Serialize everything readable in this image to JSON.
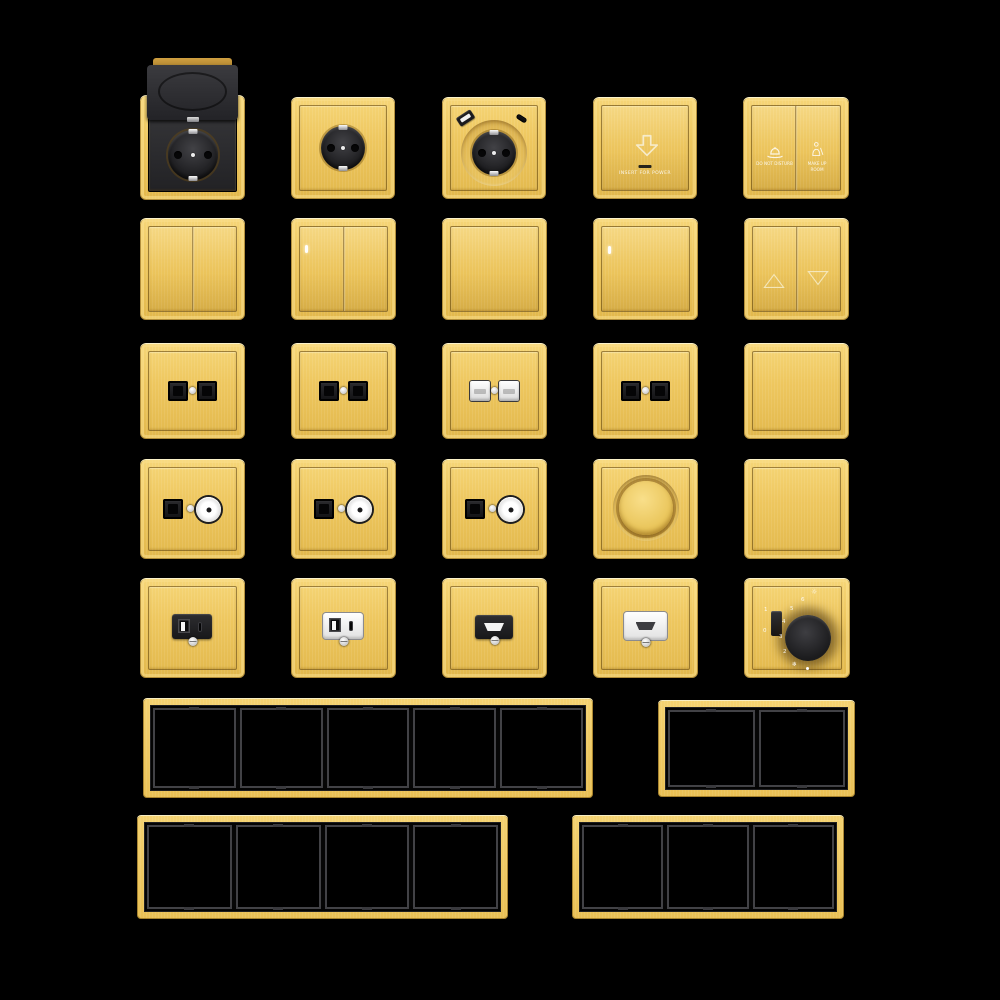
{
  "background": "#000000",
  "palette": {
    "gold": "#eec75f",
    "gold_light": "#f6d678",
    "gold_dark": "#a37a28",
    "part_black": "#232327",
    "part_white": "#f2f2f2",
    "frame_opening_black": "#000000",
    "frame_divider_gray": "#424246",
    "etch_white": "#ffffff"
  },
  "products": {
    "row1": [
      "covered schuko socket",
      "schuko socket",
      "schuko socket with USB-A and USB-C",
      "key card power holder",
      "hotel service two-button switch"
    ],
    "row2": [
      "2-gang rocker switch",
      "2-gang rocker switch with LED",
      "1-gang rocker switch",
      "1-gang rocker switch with LED",
      "curtain switch up/down"
    ],
    "row3": [
      "double data socket black",
      "double data socket black",
      "double data socket white",
      "double TV/data socket black",
      "blank plate"
    ],
    "row4": [
      "TV + data combo socket",
      "TV + data combo socket",
      "TV + data combo socket",
      "rotary dimmer",
      "blank plate"
    ],
    "row5": [
      "USB A+C charger black",
      "USB A+C charger white",
      "HDMI socket black",
      "HDMI socket white",
      "thermostat"
    ]
  },
  "texts": {
    "key_card": "INSERT FOR POWER",
    "dnd": "DO NOT DISTURB",
    "mur": "MAKE UP ROOM"
  },
  "thermostat": {
    "toggle_on": "1",
    "toggle_off": "0",
    "scale": [
      "6",
      "5",
      "4",
      "3",
      "2"
    ],
    "heat_icon": "☼",
    "cool_icon": "❄"
  },
  "frames": [
    {
      "name": "frame 5-gang",
      "gangs": 5
    },
    {
      "name": "frame 2-gang",
      "gangs": 2
    },
    {
      "name": "frame 4-gang",
      "gangs": 4
    },
    {
      "name": "frame 3-gang",
      "gangs": 3
    }
  ]
}
